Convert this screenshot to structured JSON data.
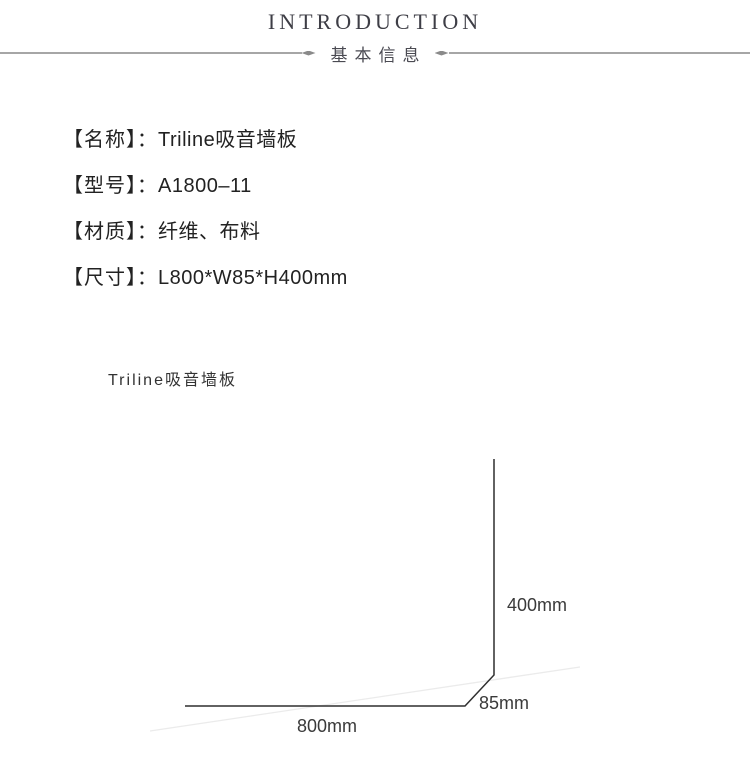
{
  "header": {
    "title": "INTRODUCTION",
    "subtitle": "基本信息"
  },
  "specs": {
    "separator": "：",
    "rows": [
      {
        "label": "【名称】",
        "value": "Triline吸音墙板"
      },
      {
        "label": "【型号】",
        "value": "A1800–11"
      },
      {
        "label": "【材质】",
        "value": "纤维、布料"
      },
      {
        "label": "【尺寸】",
        "value": "L800*W85*H400mm"
      }
    ]
  },
  "figure": {
    "caption": "Triline吸音墙板",
    "dimensions": {
      "height": "400mm",
      "depth": "85mm",
      "width": "800mm"
    }
  },
  "colors": {
    "title_text": "#3e3e46",
    "subtitle_text": "#4a4a52",
    "divider_line": "#a6a6a6",
    "spec_text": "#222222",
    "dimension_text": "#3a3a3a",
    "panel_outline": "#1b1b1b"
  }
}
